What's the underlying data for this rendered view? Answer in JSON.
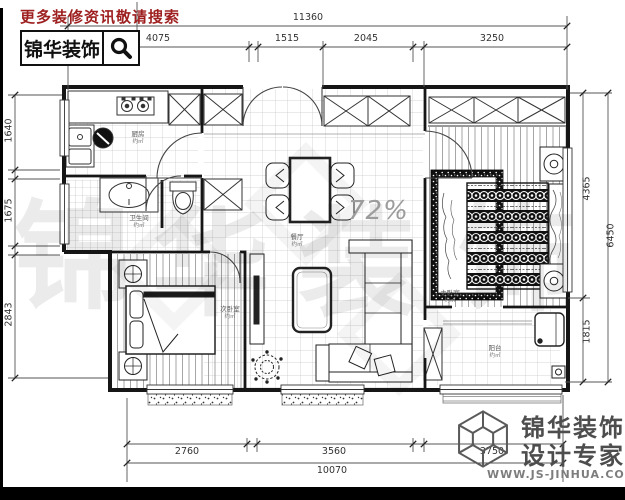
{
  "header": {
    "promo": "更多装修资讯敬请搜索",
    "brand": "锦华装饰"
  },
  "progress": "72%",
  "dimensions": {
    "top": {
      "overall": "11360",
      "segments": [
        "4075",
        "1515",
        "2045",
        "3250"
      ]
    },
    "left": [
      "1640",
      "1675",
      "2843"
    ],
    "right": {
      "inner": [
        "4365",
        "1815"
      ],
      "outer": "6450"
    },
    "bottom": {
      "segments": [
        "2760",
        "3560",
        "3750"
      ],
      "overall": "10070"
    }
  },
  "rooms": {
    "kitchen": {
      "name": "厨房",
      "area": "约㎡"
    },
    "bath": {
      "name": "卫生间",
      "area": "约㎡"
    },
    "dining": {
      "name": "餐厅",
      "area": "约㎡"
    },
    "bedroom2": {
      "name": "次卧室",
      "area": "约㎡"
    },
    "master": {
      "name": "主卧室",
      "area": "约㎡"
    },
    "balcony": {
      "name": "阳台",
      "area": "约㎡"
    }
  },
  "watermark": {
    "chars": [
      "锦",
      "华",
      "装",
      "饰"
    ]
  },
  "branding": {
    "line1": "锦华装饰",
    "line2": "设计专家",
    "url": "WWW.JS-JINHUA.COM"
  },
  "colors": {
    "promo_red": "#9e1f1f",
    "ink": "#161616",
    "dim_gray": "#555555",
    "brand_gray": "#4d4d4d"
  }
}
